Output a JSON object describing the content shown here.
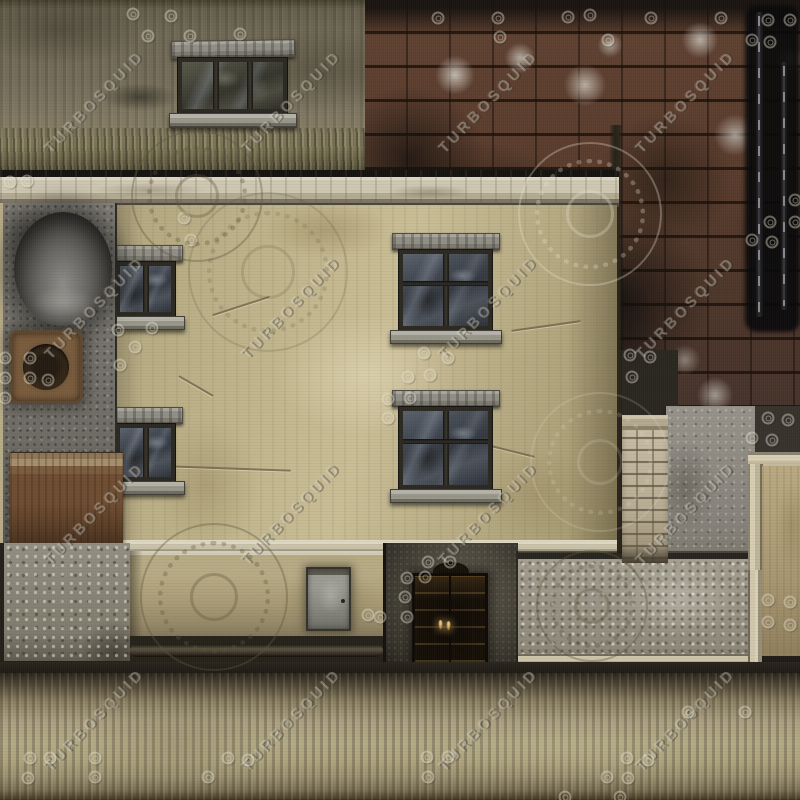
{
  "meta": {
    "title": "Weathered building facade texture atlas",
    "type": "texture-atlas",
    "canvas": {
      "width": 800,
      "height": 800
    }
  },
  "watermark": {
    "text": "TURBOSQUID",
    "texts": [
      {
        "x": 95,
        "y": 102
      },
      {
        "x": 292,
        "y": 102
      },
      {
        "x": 489,
        "y": 102
      },
      {
        "x": 686,
        "y": 102
      },
      {
        "x": 95,
        "y": 308
      },
      {
        "x": 292,
        "y": 308
      },
      {
        "x": 489,
        "y": 308
      },
      {
        "x": 686,
        "y": 308
      },
      {
        "x": 95,
        "y": 514
      },
      {
        "x": 292,
        "y": 514
      },
      {
        "x": 489,
        "y": 514
      },
      {
        "x": 686,
        "y": 514
      },
      {
        "x": 95,
        "y": 720
      },
      {
        "x": 292,
        "y": 720
      },
      {
        "x": 489,
        "y": 720
      },
      {
        "x": 686,
        "y": 720
      }
    ],
    "rings": [
      [
        133,
        14
      ],
      [
        171,
        16
      ],
      [
        148,
        36
      ],
      [
        190,
        36
      ],
      [
        240,
        34
      ],
      [
        438,
        18
      ],
      [
        498,
        18
      ],
      [
        568,
        17
      ],
      [
        590,
        15
      ],
      [
        651,
        18
      ],
      [
        721,
        18
      ],
      [
        500,
        37
      ],
      [
        608,
        40
      ],
      [
        768,
        20
      ],
      [
        790,
        20
      ],
      [
        752,
        40
      ],
      [
        770,
        42
      ],
      [
        10,
        182
      ],
      [
        27,
        181
      ],
      [
        184,
        218
      ],
      [
        191,
        240
      ],
      [
        118,
        330
      ],
      [
        152,
        328
      ],
      [
        135,
        347
      ],
      [
        120,
        365
      ],
      [
        5,
        358
      ],
      [
        30,
        358
      ],
      [
        5,
        378
      ],
      [
        30,
        378
      ],
      [
        48,
        380
      ],
      [
        5,
        398
      ],
      [
        424,
        353
      ],
      [
        448,
        358
      ],
      [
        408,
        377
      ],
      [
        430,
        375
      ],
      [
        388,
        399
      ],
      [
        410,
        398
      ],
      [
        388,
        418
      ],
      [
        795,
        200
      ],
      [
        770,
        222
      ],
      [
        795,
        222
      ],
      [
        752,
        240
      ],
      [
        772,
        242
      ],
      [
        630,
        355
      ],
      [
        650,
        357
      ],
      [
        632,
        377
      ],
      [
        768,
        418
      ],
      [
        788,
        420
      ],
      [
        752,
        438
      ],
      [
        772,
        440
      ],
      [
        768,
        600
      ],
      [
        790,
        602
      ],
      [
        768,
        622
      ],
      [
        790,
        625
      ],
      [
        368,
        615
      ],
      [
        380,
        617
      ],
      [
        428,
        562
      ],
      [
        450,
        562
      ],
      [
        407,
        578
      ],
      [
        425,
        577
      ],
      [
        405,
        597
      ],
      [
        407,
        617
      ],
      [
        688,
        712
      ],
      [
        745,
        712
      ],
      [
        30,
        758
      ],
      [
        50,
        758
      ],
      [
        95,
        758
      ],
      [
        28,
        778
      ],
      [
        95,
        777
      ],
      [
        228,
        758
      ],
      [
        248,
        760
      ],
      [
        208,
        777
      ],
      [
        427,
        757
      ],
      [
        448,
        757
      ],
      [
        428,
        777
      ],
      [
        627,
        758
      ],
      [
        648,
        760
      ],
      [
        607,
        777
      ],
      [
        628,
        778
      ],
      [
        565,
        797
      ],
      [
        620,
        797
      ]
    ],
    "gears": [
      {
        "x": 197,
        "y": 196,
        "r": 66,
        "tone": "dark",
        "faint": false
      },
      {
        "x": 268,
        "y": 272,
        "r": 80,
        "tone": "dark",
        "faint": true
      },
      {
        "x": 590,
        "y": 214,
        "r": 72,
        "tone": "light",
        "faint": false
      },
      {
        "x": 600,
        "y": 462,
        "r": 70,
        "tone": "light",
        "faint": true
      },
      {
        "x": 214,
        "y": 597,
        "r": 74,
        "tone": "dark",
        "faint": false
      },
      {
        "x": 592,
        "y": 606,
        "r": 56,
        "tone": "dark",
        "faint": false
      }
    ]
  },
  "palette": {
    "olive_wall": "#746c58",
    "brick_red": "#5e4030",
    "brick_soot": "#14110d",
    "efflorescence": "#cdc9c0",
    "cornice_light": "#cdc6b1",
    "main_wall_beige": "#c2b68d",
    "window_glass": "#454b54",
    "window_stone": "#908e85",
    "panel_gray": "#7e7b74",
    "beam_rust": "#6f4d31",
    "concrete_speckle": "#9d9889",
    "pillar_brick": "#bfb49a",
    "tan_strip": "#b1a07b",
    "bottom_grass": "#b3a985",
    "shadow_dark": "#1f1b16"
  },
  "regions": [
    {
      "name": "top-left-olive-wall",
      "label": "mossy olive concrete wall with barred window"
    },
    {
      "name": "brick-field",
      "label": "sooted red brick wall with efflorescence and two dark metal rods"
    },
    {
      "name": "cornice",
      "label": "light stone cornice ledge"
    },
    {
      "name": "main-beige-wall",
      "label": "stained beige plaster facade with four sash windows"
    },
    {
      "name": "left-equipment-panel",
      "label": "gray panel with dark dome and rusted round vent"
    },
    {
      "name": "rust-beam",
      "label": "rusted brown beam"
    },
    {
      "name": "speckled-block",
      "label": "speckled gray concrete block"
    },
    {
      "name": "door-wall",
      "label": "tan wall with gray metal door"
    },
    {
      "name": "dark-entry",
      "label": "dark grungy recess with ornate paneled double door and two lights"
    },
    {
      "name": "swirl-concrete-panel",
      "label": "light speckled concrete slab with embossed logo"
    },
    {
      "name": "right-concrete-step",
      "label": "gray concrete with beige step molding and tan strip"
    },
    {
      "name": "stone-pillar",
      "label": "light stone brick pillar with cap"
    },
    {
      "name": "bottom-grass-strip",
      "label": "horizontal mossy gradient strip"
    }
  ]
}
